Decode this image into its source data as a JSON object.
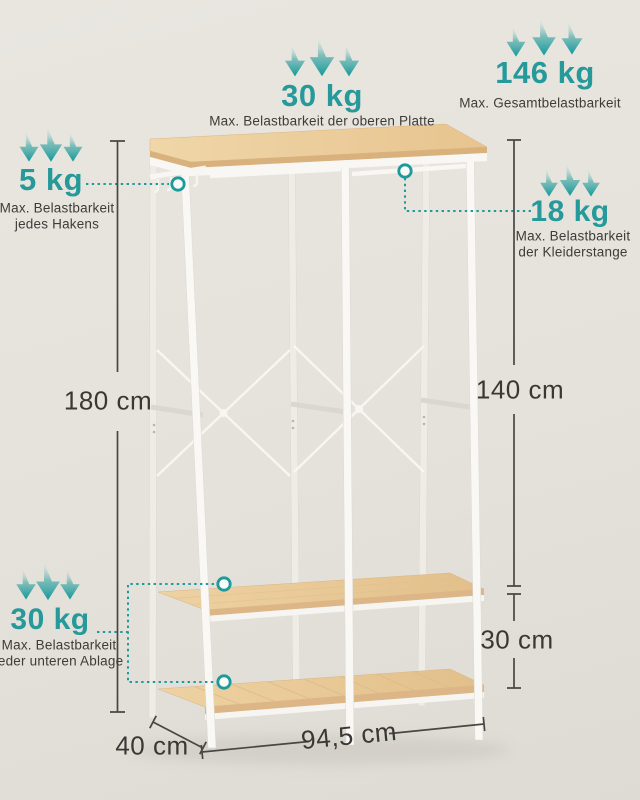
{
  "page": {
    "type": "product-load-infographic",
    "language": "de"
  },
  "colors": {
    "accent_teal": "#1d9a9b",
    "text_dark": "#3e3c39",
    "dimension_line": "#494744",
    "wood_light": "#ecd0a0",
    "frame_white": "#f8f7f4",
    "background": "#e5e2db"
  },
  "annotations": {
    "top_plate": {
      "value": "30 kg",
      "description": "Max. Belastbarkeit der oberen Platte"
    },
    "total_load": {
      "value": "146 kg",
      "description": "Max. Gesamtbelastbarkeit"
    },
    "hooks": {
      "value": "5 kg",
      "description_line1": "Max. Belastbarkeit",
      "description_line2": "jedes Hakens"
    },
    "clothes_rail": {
      "value": "18 kg",
      "description_line1": "Max. Belastbarkeit",
      "description_line2": "der Kleiderstange"
    },
    "lower_shelves": {
      "value": "30 kg",
      "description_line1": "Max. Belastbarkeit",
      "description_line2": "jeder unteren Ablage"
    }
  },
  "dimensions": {
    "total_height": "180 cm",
    "rail_height": "140 cm",
    "shelf_spacing": "30 cm",
    "width": "94,5 cm",
    "depth": "40 cm"
  },
  "icons": {
    "load_arrows": "triple-down-arrow-icon",
    "callout_marker": "circle-point-marker-icon"
  }
}
